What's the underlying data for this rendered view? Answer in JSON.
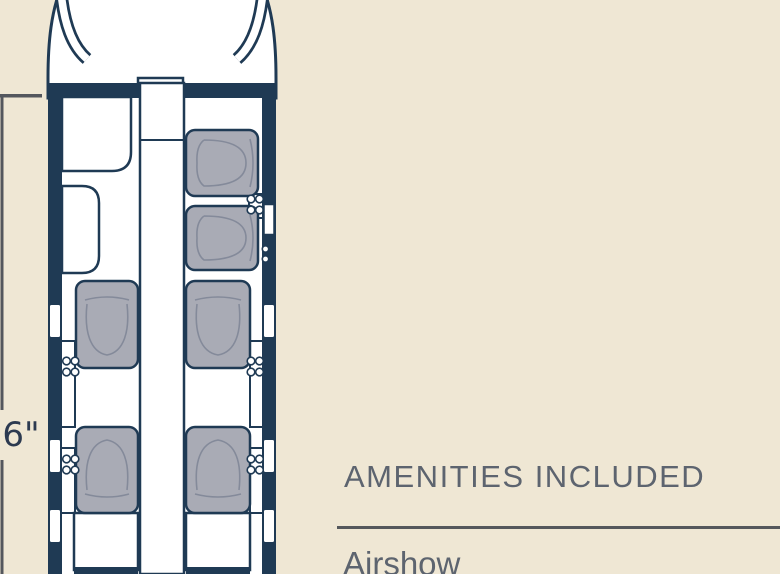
{
  "theme": {
    "background": "#efe7d4",
    "paper": "#ffffff",
    "navy": "#1f3a54",
    "seat_gray": "#a9abb5",
    "seat_inner": "#848a9a",
    "text_gray": "#5d646f",
    "rule_gray": "#55585c",
    "dim_line": "#54575d",
    "label_navy": "#2c3a50"
  },
  "floorplan": {
    "dimension_label": "'6\"",
    "visible_seats": 6,
    "windows_per_side": 3
  },
  "amenities": {
    "heading": "AMENITIES INCLUDED",
    "items": [
      "Airshow"
    ]
  }
}
